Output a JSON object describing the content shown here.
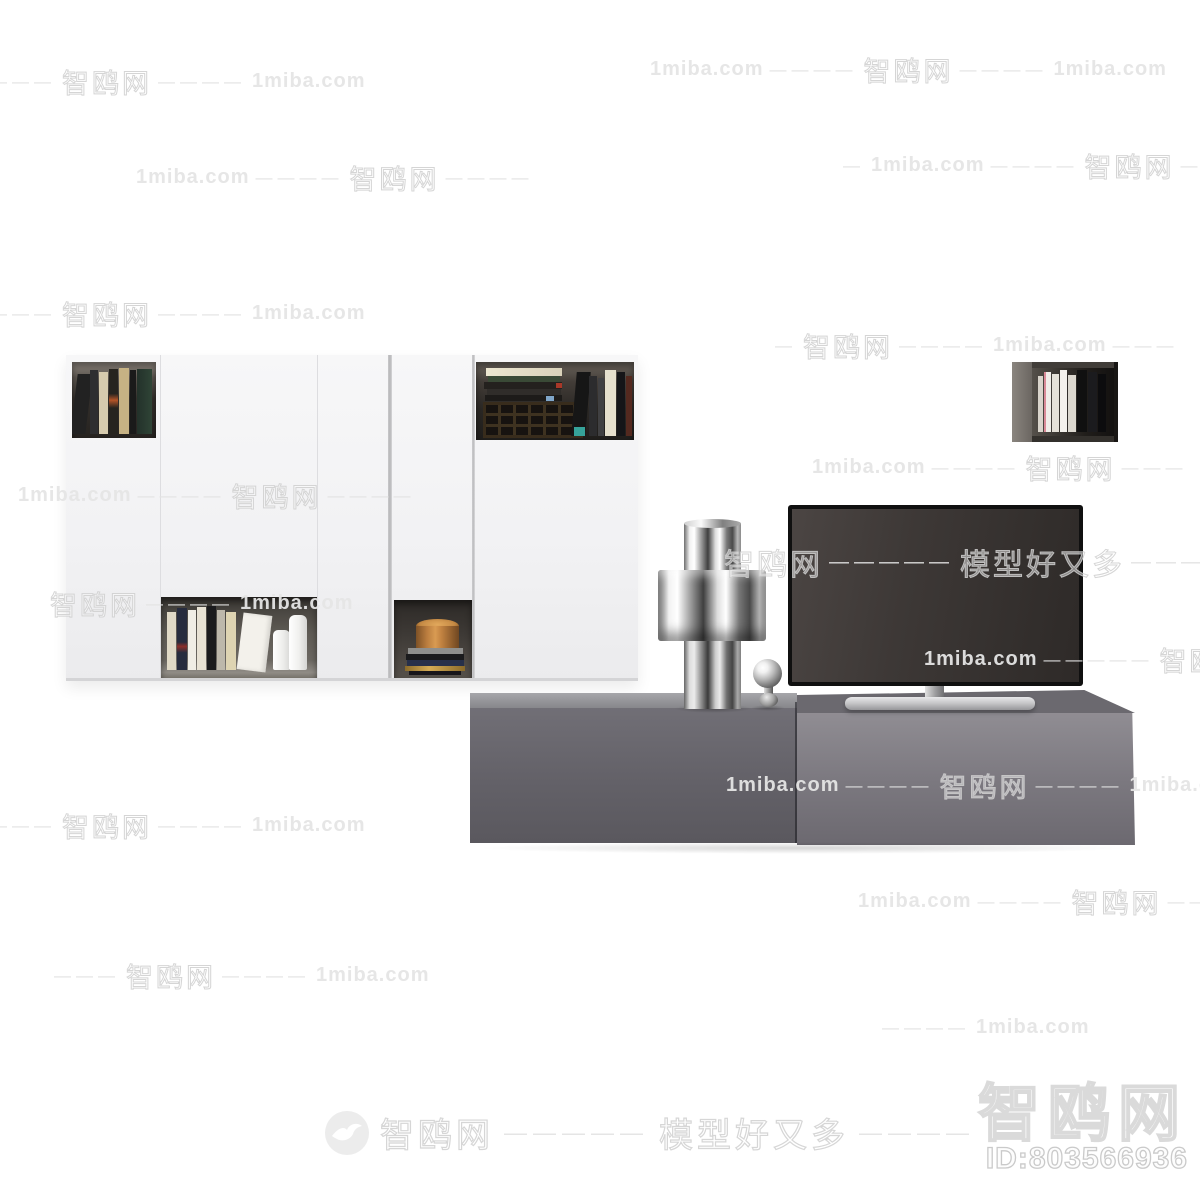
{
  "brand": {
    "site_name": "智鸥网",
    "site_domain": "1miba.com",
    "slogan": "模型好又多",
    "model_id": "ID:803566936",
    "logo_icon": "gull-in-circle"
  },
  "watermark": {
    "site": "智鸥网",
    "domain": "1miba.com",
    "slogan": "模型好又多",
    "dash1": "—",
    "dash3": "———",
    "dash4": "————",
    "dash5": "—————"
  },
  "colors": {
    "background": "#ffffff",
    "cabinet_white": "#f3f3f4",
    "console_grey": "#66646a",
    "tv_screen": "#3a3533",
    "watermark_grey": "#d9d9d9",
    "wood_tan": "#c08748"
  }
}
